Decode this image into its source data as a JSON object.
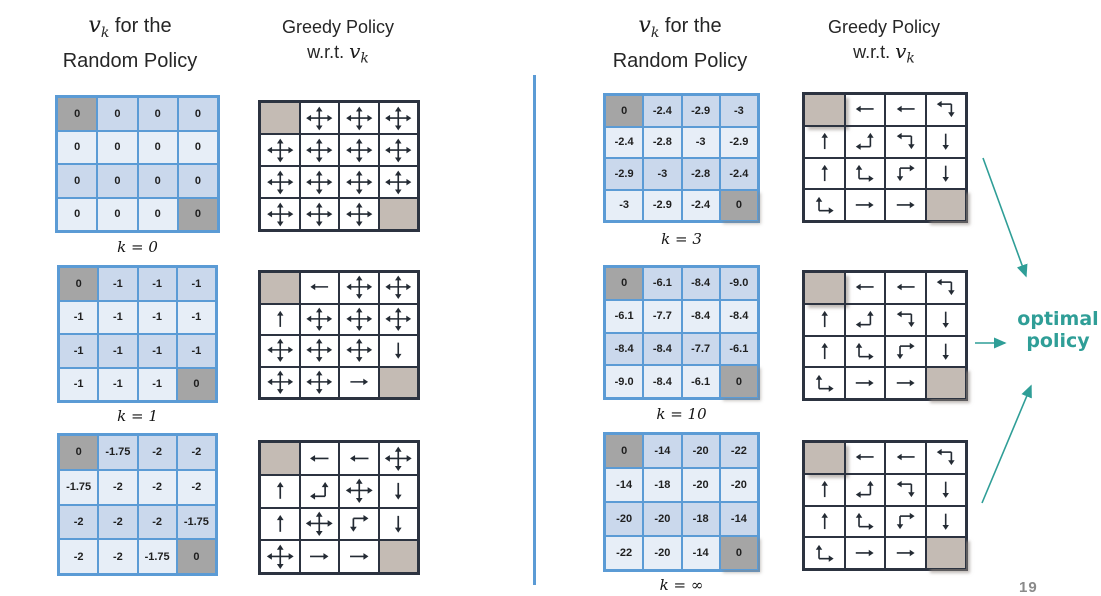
{
  "titles": {
    "v": "v",
    "k_sub": "k",
    "for_the": " for the",
    "random_policy": "Random Policy",
    "greedy": "Greedy Policy",
    "wrt": "w.r.t. "
  },
  "annotation": {
    "line1": "optimal",
    "line2": "policy"
  },
  "page_number": "19",
  "colors": {
    "value_border": "#5b9bd5",
    "value_row_dark": "#cad8ec",
    "value_row_light": "#e7eef7",
    "value_terminal": "#a5a5a5",
    "policy_border": "#2c3340",
    "policy_terminal": "#c4bbb4",
    "arrow": "#242b34",
    "teal_accent": "#2f9e97",
    "divider": "#5b9bd5",
    "page_number_gray": "#8a8a8a"
  },
  "sections": [
    {
      "k_label": "k  = 0",
      "values": [
        [
          "0",
          "0",
          "0",
          "0"
        ],
        [
          "0",
          "0",
          "0",
          "0"
        ],
        [
          "0",
          "0",
          "0",
          "0"
        ],
        [
          "0",
          "0",
          "0",
          "0"
        ]
      ],
      "terminals": [
        [
          0,
          0
        ],
        [
          3,
          3
        ]
      ],
      "policy": [
        [
          "T",
          "ALL",
          "ALL",
          "ALL"
        ],
        [
          "ALL",
          "ALL",
          "ALL",
          "ALL"
        ],
        [
          "ALL",
          "ALL",
          "ALL",
          "ALL"
        ],
        [
          "ALL",
          "ALL",
          "ALL",
          "T"
        ]
      ]
    },
    {
      "k_label": "k  = 1",
      "values": [
        [
          "0",
          "-1",
          "-1",
          "-1"
        ],
        [
          "-1",
          "-1",
          "-1",
          "-1"
        ],
        [
          "-1",
          "-1",
          "-1",
          "-1"
        ],
        [
          "-1",
          "-1",
          "-1",
          "0"
        ]
      ],
      "terminals": [
        [
          0,
          0
        ],
        [
          3,
          3
        ]
      ],
      "policy": [
        [
          "T",
          "L",
          "ALL",
          "ALL"
        ],
        [
          "U",
          "ALL",
          "ALL",
          "ALL"
        ],
        [
          "ALL",
          "ALL",
          "ALL",
          "D"
        ],
        [
          "ALL",
          "ALL",
          "R",
          "T"
        ]
      ]
    },
    {
      "k_label": "",
      "values": [
        [
          "0",
          "-1.75",
          "-2",
          "-2"
        ],
        [
          "-1.75",
          "-2",
          "-2",
          "-2"
        ],
        [
          "-2",
          "-2",
          "-2",
          "-1.75"
        ],
        [
          "-2",
          "-2",
          "-1.75",
          "0"
        ]
      ],
      "terminals": [
        [
          0,
          0
        ],
        [
          3,
          3
        ]
      ],
      "policy": [
        [
          "T",
          "L",
          "L",
          "ALL"
        ],
        [
          "U",
          "LU",
          "ALL",
          "D"
        ],
        [
          "U",
          "ALL",
          "RD",
          "D"
        ],
        [
          "ALL",
          "R",
          "R",
          "T"
        ]
      ]
    },
    {
      "k_label": "k  = 3",
      "values": [
        [
          "0",
          "-2.4",
          "-2.9",
          "-3"
        ],
        [
          "-2.4",
          "-2.8",
          "-3",
          "-2.9"
        ],
        [
          "-2.9",
          "-3",
          "-2.8",
          "-2.4"
        ],
        [
          "-3",
          "-2.9",
          "-2.4",
          "0"
        ]
      ],
      "terminals": [
        [
          0,
          0
        ],
        [
          3,
          3
        ]
      ],
      "policy": [
        [
          "T",
          "L",
          "L",
          "LD"
        ],
        [
          "U",
          "LU",
          "LD",
          "D"
        ],
        [
          "U",
          "UR",
          "RD",
          "D"
        ],
        [
          "UR",
          "R",
          "R",
          "T"
        ]
      ]
    },
    {
      "k_label": "k  = 10",
      "values": [
        [
          "0",
          "-6.1",
          "-8.4",
          "-9.0"
        ],
        [
          "-6.1",
          "-7.7",
          "-8.4",
          "-8.4"
        ],
        [
          "-8.4",
          "-8.4",
          "-7.7",
          "-6.1"
        ],
        [
          "-9.0",
          "-8.4",
          "-6.1",
          "0"
        ]
      ],
      "terminals": [
        [
          0,
          0
        ],
        [
          3,
          3
        ]
      ],
      "policy": [
        [
          "T",
          "L",
          "L",
          "LD"
        ],
        [
          "U",
          "LU",
          "LD",
          "D"
        ],
        [
          "U",
          "UR",
          "RD",
          "D"
        ],
        [
          "UR",
          "R",
          "R",
          "T"
        ]
      ]
    },
    {
      "k_label": "k  = ∞",
      "values": [
        [
          "0",
          "-14",
          "-20",
          "-22"
        ],
        [
          "-14",
          "-18",
          "-20",
          "-20"
        ],
        [
          "-20",
          "-20",
          "-18",
          "-14"
        ],
        [
          "-22",
          "-20",
          "-14",
          "0"
        ]
      ],
      "terminals": [
        [
          0,
          0
        ],
        [
          3,
          3
        ]
      ],
      "policy": [
        [
          "T",
          "L",
          "L",
          "LD"
        ],
        [
          "U",
          "LU",
          "LD",
          "D"
        ],
        [
          "U",
          "UR",
          "RD",
          "D"
        ],
        [
          "UR",
          "R",
          "R",
          "T"
        ]
      ]
    }
  ]
}
